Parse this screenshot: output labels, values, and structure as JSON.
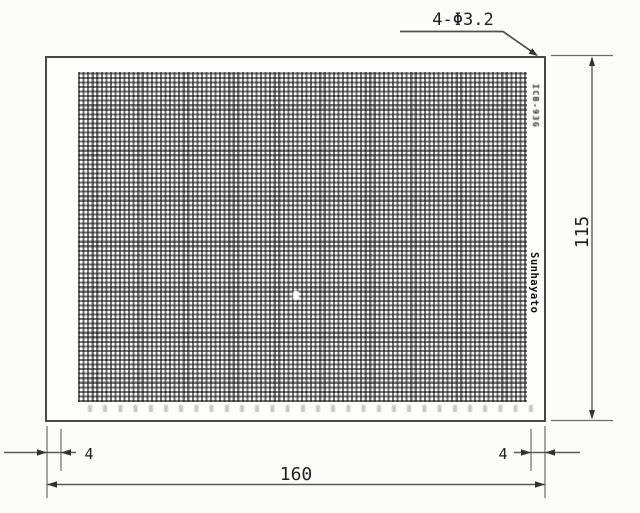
{
  "drawing": {
    "hole_callout": "4-Φ3.2",
    "dim_width": "160",
    "dim_height": "115",
    "dim_margin_left": "4",
    "dim_margin_right": "4",
    "board_model": "ICB-93G",
    "brand": "Sunhayato"
  },
  "colors": {
    "background": "#fcfcfb",
    "board_outline": "#474747",
    "grid_line": "#161616",
    "dimension_line": "#5c5c5c",
    "text": "#1f1f1f"
  }
}
